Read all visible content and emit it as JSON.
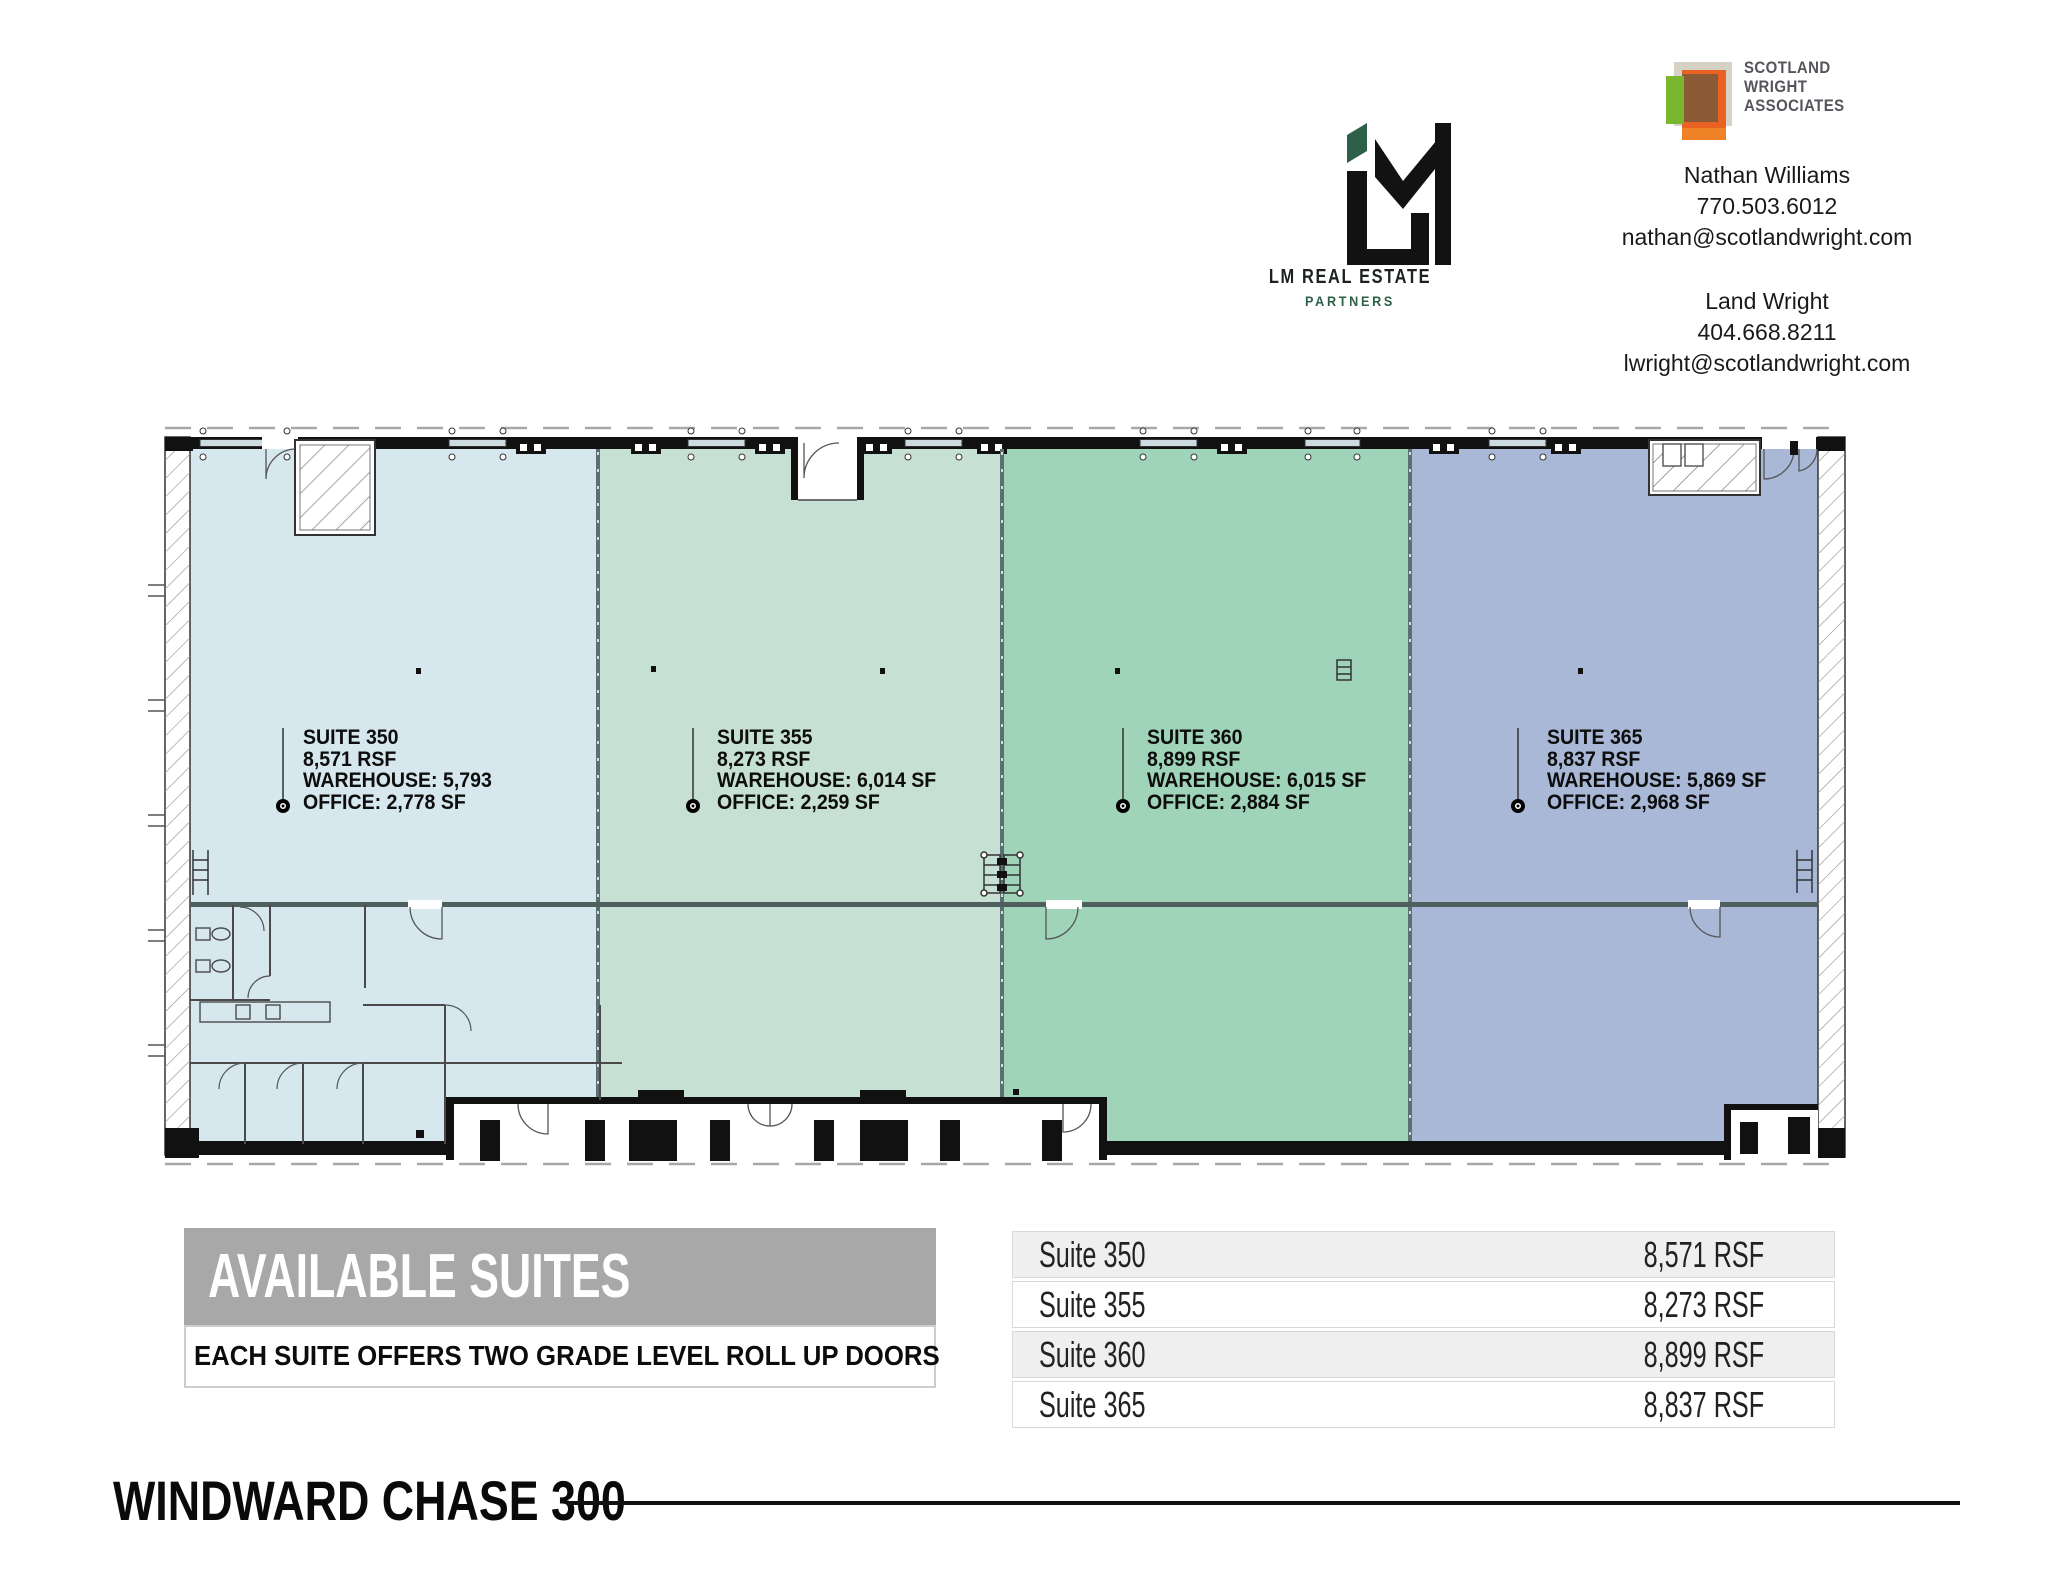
{
  "branding": {
    "lm": {
      "name_line1": "LM REAL ESTATE",
      "name_line2": "PARTNERS",
      "accent_green": "#2d5f49"
    },
    "scotland_wright": {
      "logo_line1": "SCOTLAND",
      "logo_line2": "WRIGHT",
      "logo_line3": "ASSOCIATES",
      "logo_colors": {
        "beige": "#d7d2c6",
        "orange": "#e96224",
        "brown": "#8c5a34",
        "green": "#7ab62e"
      }
    },
    "contacts": [
      {
        "name": "Nathan Williams",
        "phone": "770.503.6012",
        "email": "nathan@scotlandwright.com"
      },
      {
        "name": "Land Wright",
        "phone": "404.668.8211",
        "email": "lwright@scotlandwright.com"
      }
    ]
  },
  "floor_plan": {
    "suites": [
      {
        "label": "SUITE 350",
        "rsf_line": "8,571 RSF",
        "warehouse_line": "WAREHOUSE: 5,793",
        "office_line": "OFFICE: 2,778 SF",
        "color": "#d6e7ee"
      },
      {
        "label": "SUITE 355",
        "rsf_line": "8,273 RSF",
        "warehouse_line": "WAREHOUSE: 6,014 SF",
        "office_line": "OFFICE: 2,259 SF",
        "color": "#c6e1d4"
      },
      {
        "label": "SUITE 360",
        "rsf_line": "8,899 RSF",
        "warehouse_line": "WAREHOUSE: 6,015 SF",
        "office_line": "OFFICE: 2,884 SF",
        "color": "#a0d4b8"
      },
      {
        "label": "SUITE 365",
        "rsf_line": "8,837 RSF",
        "warehouse_line": "WAREHOUSE: 5,869 SF",
        "office_line": "OFFICE: 2,968 SF",
        "color": "#a8b8d6"
      }
    ]
  },
  "available_suites": {
    "header": "AVAILABLE SUITES",
    "subheader": "EACH SUITE OFFERS TWO GRADE LEVEL ROLL UP DOORS",
    "header_bg": "#a8a8a8",
    "table": {
      "rows": [
        {
          "suite": "Suite 350",
          "rsf": "8,571 RSF"
        },
        {
          "suite": "Suite 355",
          "rsf": "8,273 RSF"
        },
        {
          "suite": "Suite 360",
          "rsf": "8,899 RSF"
        },
        {
          "suite": "Suite 365",
          "rsf": "8,837 RSF"
        }
      ]
    }
  },
  "footer": {
    "title": "WINDWARD CHASE 300"
  }
}
